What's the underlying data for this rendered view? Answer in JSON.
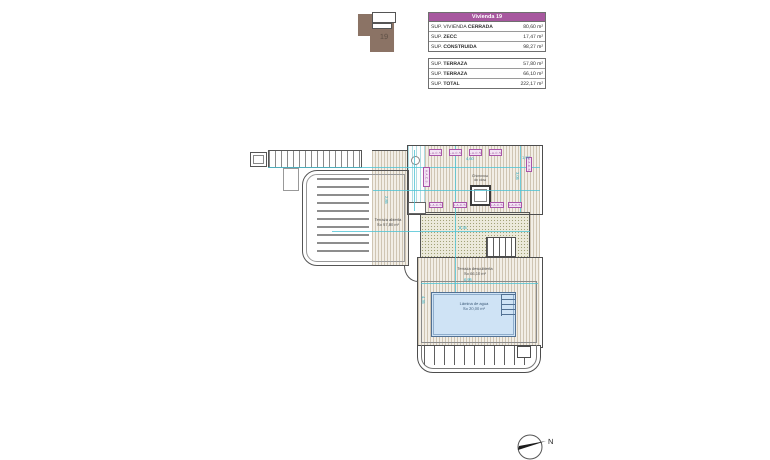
{
  "key_plan": {
    "plot_number": "19"
  },
  "tables": {
    "header": "Vivienda 19",
    "vivienda_rows": [
      {
        "prefix": "SUP. VIVIENDA ",
        "bold": "CERRADA",
        "value": "80,60 m²"
      },
      {
        "prefix": "SUP. ",
        "bold": "ZECC",
        "value": "17,47 m²"
      },
      {
        "prefix": "SUP. ",
        "bold": "CONSTRUIDA",
        "value": "98,27 m²"
      }
    ],
    "terraza_rows": [
      {
        "prefix": "SUP. ",
        "bold": "TERRAZA",
        "value": "57,80 m²"
      },
      {
        "prefix": "SUP. ",
        "bold": "TERRAZA",
        "value": "66,10 m²"
      },
      {
        "prefix": "SUP. ",
        "bold": "TOTAL",
        "value": "222,17 m²"
      }
    ]
  },
  "plan": {
    "labels": {
      "terraza_abierta_l1": "Terraza abierta",
      "terraza_abierta_l2": "S= 57,80 m²",
      "chimenea_l1": "Chimenea",
      "chimenea_l2": "de obra",
      "terraza_desc_l1": "Terraza descubierta",
      "terraza_desc_l2": "S= 66,10 m²",
      "pool_l1": "Lámina de agua",
      "pool_l2": "S= 20,00 m²"
    },
    "unit_label": "A.A.C.S.",
    "dimensions": [
      "4,60",
      "1,97",
      "3,05",
      "2,85",
      "8,35",
      "6,95",
      "4,35"
    ]
  },
  "compass": {
    "label": "N"
  },
  "colors": {
    "accent_purple": "#a7589f",
    "unit_magenta": "#a855a8",
    "dim_cyan": "#23a9c0",
    "pool_blue": "#cfe3f5",
    "plot_brown": "#8b7365"
  }
}
